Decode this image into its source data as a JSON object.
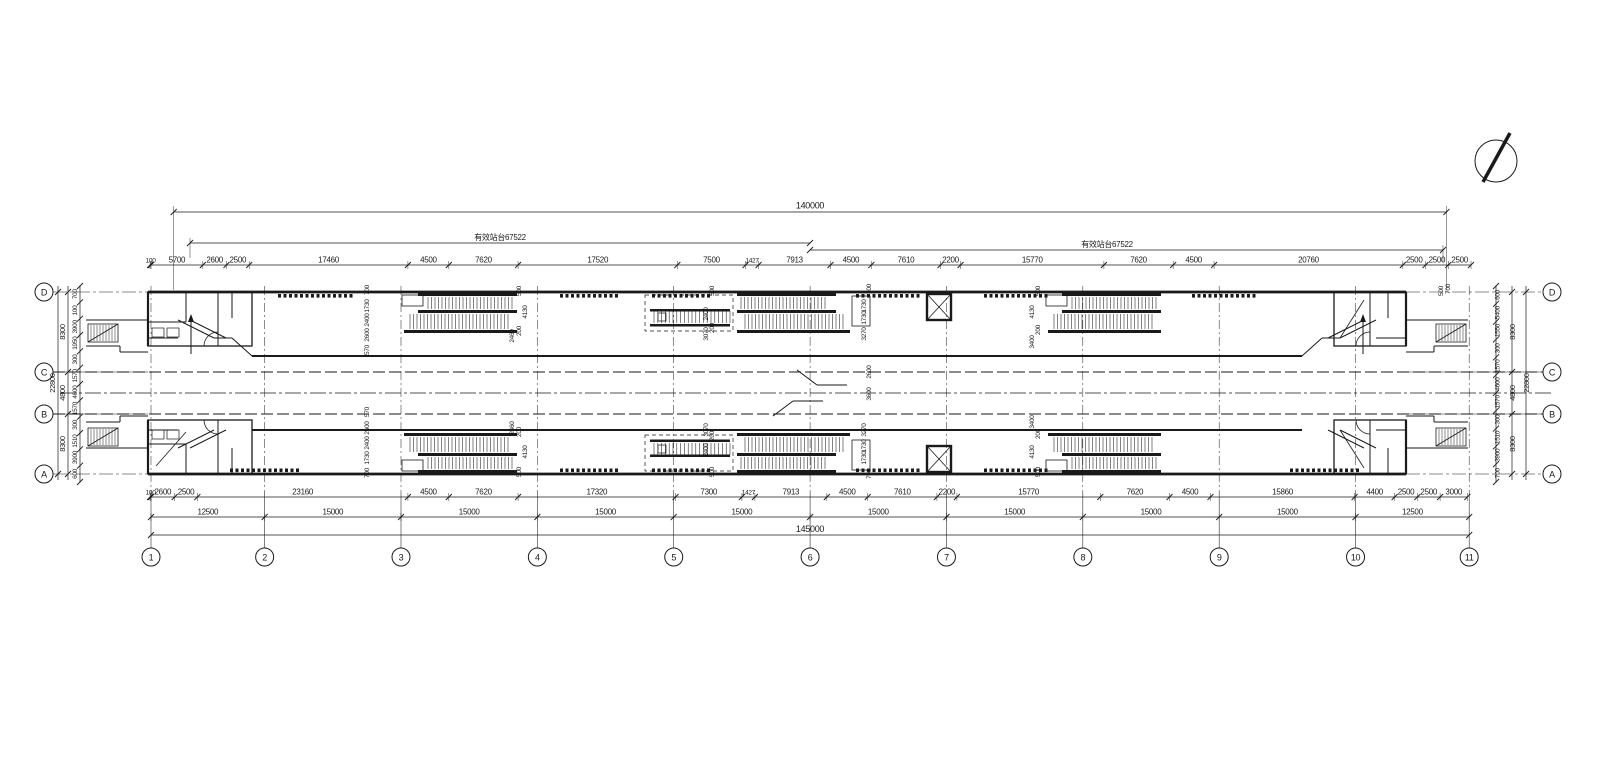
{
  "meta": {
    "ink": "#1a1a1a",
    "paper": "#ffffff"
  },
  "north_arrow": {
    "name": "north-arrow"
  },
  "grid": {
    "columns": [
      "1",
      "2",
      "3",
      "4",
      "5",
      "6",
      "7",
      "8",
      "9",
      "10",
      "11"
    ],
    "rows": [
      "D",
      "C",
      "B",
      "A"
    ],
    "column_spacings_mm": [
      12500,
      15000,
      15000,
      15000,
      15000,
      15000,
      15000,
      15000,
      15000,
      12500
    ]
  },
  "dimensions": {
    "overall_top": "140000",
    "overall_bottom": "145000",
    "platform_label_left": "有效站台67522",
    "platform_label_right": "有效站台67522",
    "top_chain": [
      "100",
      "5700",
      "2600",
      "2500",
      "17460",
      "4500",
      "7620",
      "17520",
      "7500",
      "1427",
      "7913",
      "4500",
      "7610",
      "2200",
      "15770",
      "7620",
      "4500",
      "20760",
      "2500",
      "2500",
      "2500"
    ],
    "bottom_chain": [
      "100",
      "2600",
      "2500",
      "23160",
      "4500",
      "7620",
      "17320",
      "7300",
      "1427",
      "7913",
      "4500",
      "7610",
      "2200",
      "15770",
      "7620",
      "4500",
      "15860",
      "4400",
      "2500",
      "2500",
      "3000"
    ],
    "axis_chain": [
      "12500",
      "15000",
      "15000",
      "15000",
      "15000",
      "15000",
      "15000",
      "15000",
      "15000",
      "12500"
    ],
    "left_inner": [
      "700",
      "100",
      "3900",
      "1950",
      "300",
      "1570",
      "4600",
      "1570",
      "300",
      "1510",
      "3900",
      "600"
    ],
    "left_mid": [
      "8300",
      "4800",
      "8300"
    ],
    "left_overall": "22800",
    "right_inner": [
      "600",
      "5400",
      "1550",
      "300",
      "1570",
      "4600",
      "1570",
      "300",
      "1510",
      "3900",
      "700"
    ],
    "right_mid": [
      "8300",
      "4800",
      "8300"
    ],
    "right_overall": "22800",
    "plan_dims": [
      "700",
      "1730",
      "2400",
      "2600",
      "570",
      "500",
      "4130",
      "200",
      "2460",
      "500",
      "2400",
      "200",
      "3070",
      "700",
      "1730",
      "1730",
      "3270",
      "2600",
      "3600",
      "500",
      "4130",
      "200",
      "3400",
      "570",
      "2600",
      "2400",
      "1730",
      "700",
      "2460",
      "200",
      "4130",
      "500",
      "3070",
      "200",
      "2400",
      "500",
      "3270",
      "1730",
      "1730",
      "700",
      "3400",
      "200",
      "4130",
      "500",
      "500",
      "700"
    ]
  }
}
